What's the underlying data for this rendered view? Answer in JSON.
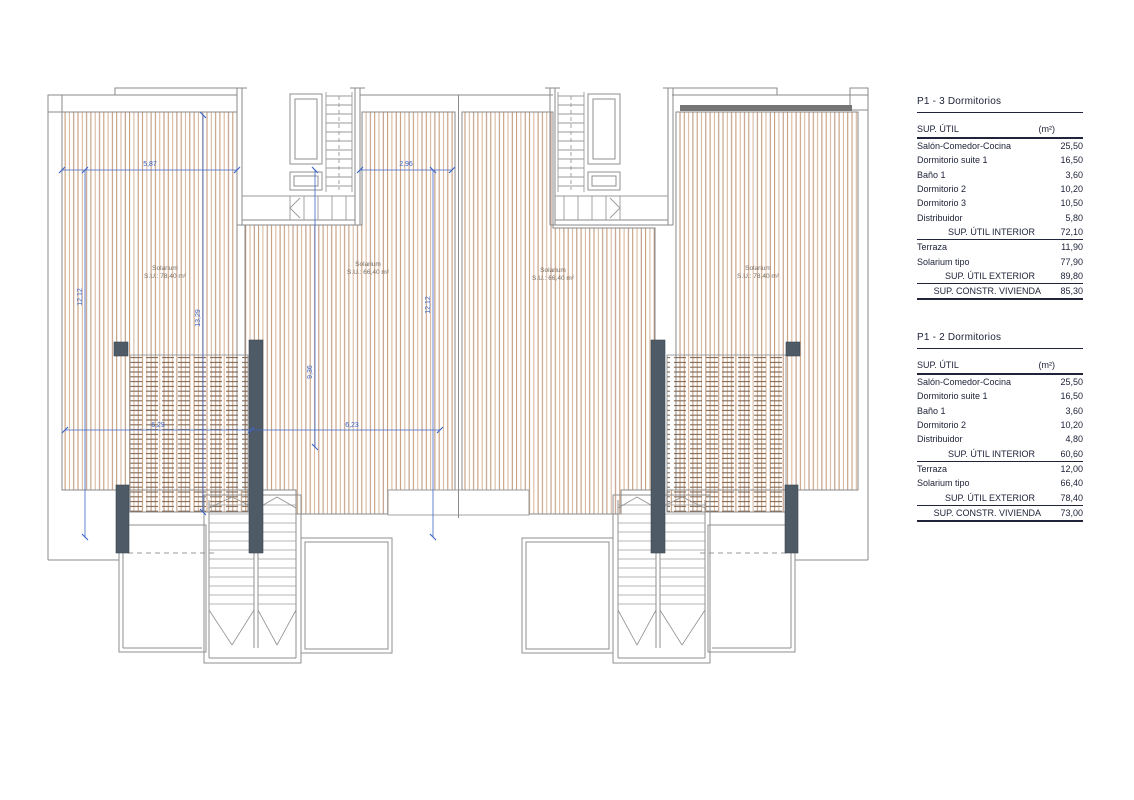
{
  "colors": {
    "dimension_blue": "#3d66c8",
    "hatch_tan": "#c79d81",
    "wall_dark": "#4e5a66",
    "table_ink": "#20243a"
  },
  "plan": {
    "units": [
      {
        "name": "Solarium",
        "area": "S.U.: 78,40 m²"
      },
      {
        "name": "Solarium",
        "area": "S.U.: 66,40 m²"
      },
      {
        "name": "Solarium",
        "area": "S.U.: 66,40 m²"
      },
      {
        "name": "Solarium",
        "area": "S.U.: 78,40 m²"
      }
    ],
    "dimensions": {
      "top_left": "5,87",
      "top_middle": "2,96",
      "left_vertical": "12,12",
      "center_left_vertical": "13,29",
      "center_vertical": "9,36",
      "center_right_vertical": "12,12",
      "bottom_left": "6,29",
      "bottom_center": "6,23"
    }
  },
  "tables": [
    {
      "title": "P1 - 3 Dormitorios",
      "header": {
        "label": "SUP. ÚTIL",
        "unit": "(m²)"
      },
      "rows": [
        {
          "label": "Salón-Comedor-Cocina",
          "value": "25,50"
        },
        {
          "label": "Dormitorio suite 1",
          "value": "16,50"
        },
        {
          "label": "Baño 1",
          "value": "3,60"
        },
        {
          "label": "Dormitorio 2",
          "value": "10,20"
        },
        {
          "label": "Dormitorio 3",
          "value": "10,50"
        },
        {
          "label": "Distribuidor",
          "value": "5,80"
        }
      ],
      "interior_total": {
        "label": "SUP. ÚTIL INTERIOR",
        "value": "72,10"
      },
      "exterior_rows": [
        {
          "label": "Terraza",
          "value": "11,90"
        },
        {
          "label": "Solarium tipo",
          "value": "77,90"
        }
      ],
      "exterior_total": {
        "label": "SUP. ÚTIL EXTERIOR",
        "value": "89,80"
      },
      "constructed_total": {
        "label": "SUP. CONSTR. VIVIENDA",
        "value": "85,30"
      }
    },
    {
      "title": "P1 - 2 Dormitorios",
      "header": {
        "label": "SUP. ÚTIL",
        "unit": "(m²)"
      },
      "rows": [
        {
          "label": "Salón-Comedor-Cocina",
          "value": "25,50"
        },
        {
          "label": "Dormitorio suite 1",
          "value": "16,50"
        },
        {
          "label": "Baño 1",
          "value": "3,60"
        },
        {
          "label": "Dormitorio 2",
          "value": "10,20"
        },
        {
          "label": "Distribuidor",
          "value": "4,80"
        }
      ],
      "interior_total": {
        "label": "SUP. ÚTIL INTERIOR",
        "value": "60,60"
      },
      "exterior_rows": [
        {
          "label": "Terraza",
          "value": "12,00"
        },
        {
          "label": "Solarium tipo",
          "value": "66,40"
        }
      ],
      "exterior_total": {
        "label": "SUP. ÚTIL EXTERIOR",
        "value": "78,40"
      },
      "constructed_total": {
        "label": "SUP. CONSTR. VIVIENDA",
        "value": "73,00"
      }
    }
  ]
}
